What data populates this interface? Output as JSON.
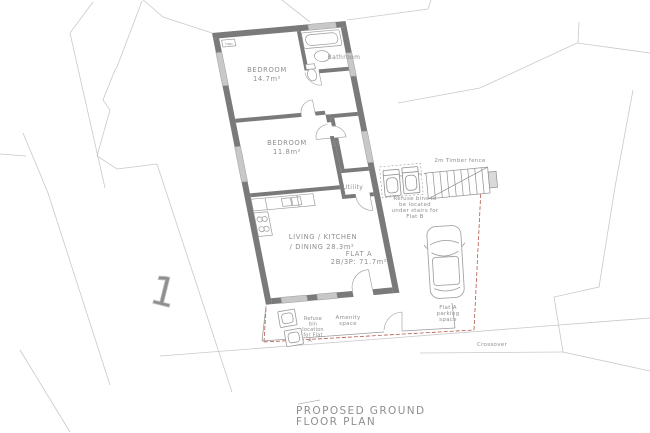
{
  "drawing": {
    "title_lines": [
      "PROPOSED GROUND",
      "FLOOR PLAN"
    ],
    "plot_number": "1"
  },
  "flat": {
    "name": "FLAT A",
    "spec": "2B/3P: 71.7m²"
  },
  "rooms": {
    "bedroom1": {
      "name": "BEDROOM",
      "area": "14.7m²"
    },
    "bedroom2": {
      "name": "BEDROOM",
      "area": "11.8m²"
    },
    "bathroom": "Bathroom",
    "storage": "ST",
    "utility": "Utility",
    "living_lines": [
      "LIVING / KITCHEN",
      "/ DINING 28.3m²"
    ],
    "cupboard": "hwp"
  },
  "site": {
    "fence_label": "2m Timber fence",
    "refuse_flat_b_lines": [
      "Refuse bins to",
      "be located",
      "under stairs for",
      "Flat B"
    ],
    "parking_lines": [
      "Flat A",
      "parking",
      "space"
    ],
    "refuse_flat_a_lines": [
      "Refuse",
      "bin",
      "location",
      "for Flat",
      "A"
    ],
    "amenity_lines": [
      "Amenity",
      "space"
    ],
    "crossover": "Crossover"
  },
  "colors": {
    "background": "#ffffff",
    "wall": "#7a7a7a",
    "window": "#c8c8c8",
    "fixture_line": "#9a9a9a",
    "text": "#8f8f8f",
    "context_line": "#c9c9c9",
    "boundary_red": "#b2594a"
  }
}
